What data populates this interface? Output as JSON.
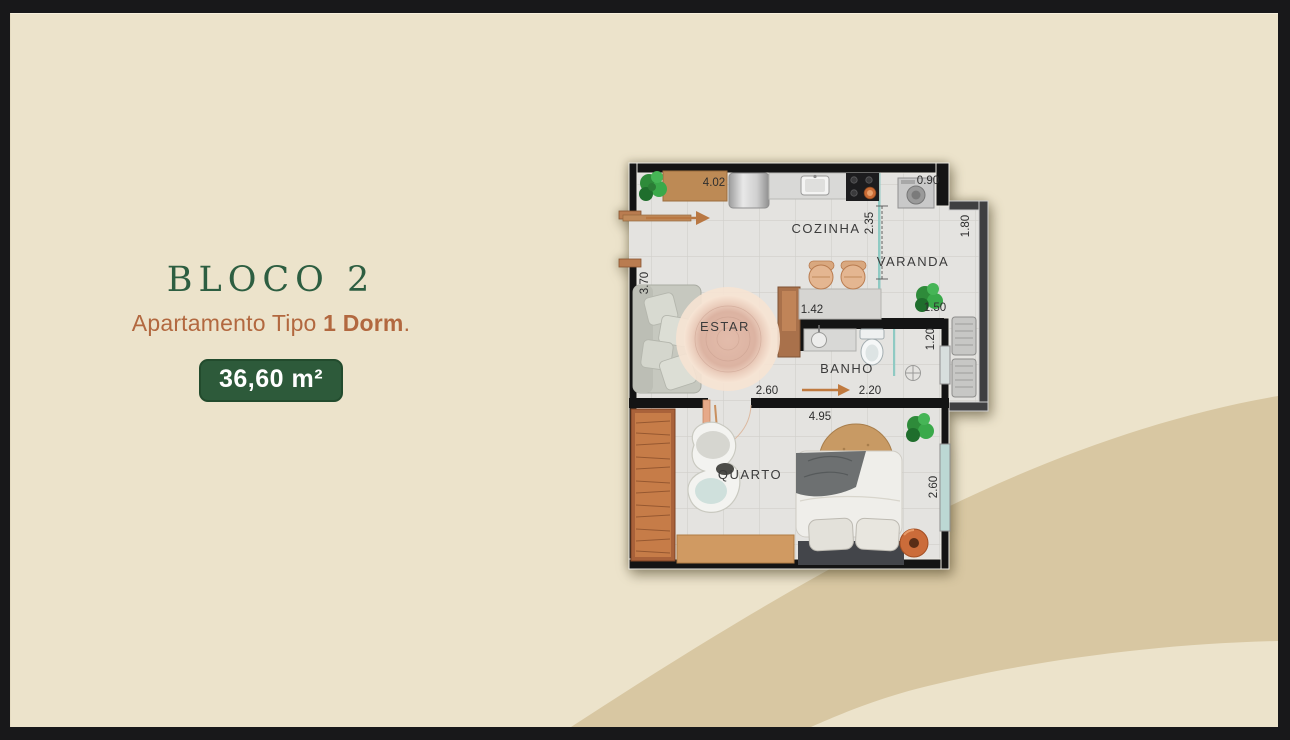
{
  "frame": {
    "color": "#18181a"
  },
  "canvas": {
    "background": "#ece3cb",
    "wave_color": "#d8c7a2"
  },
  "info_panel": {
    "block_title": "BLOCO 2",
    "type_prefix": "Apartamento Tipo ",
    "type_bold": "1 Dorm",
    "type_suffix": ".",
    "area_badge": "36,60 m²",
    "title_color": "#2d5e41",
    "subtitle_color": "#b2683f",
    "badge_background": "#2d5a3a",
    "badge_text_color": "#ffffff"
  },
  "floorplan": {
    "rooms": {
      "kitchen": "COZINHA",
      "balcony": "VARANDA",
      "living": "ESTAR",
      "bathroom": "BANHO",
      "bedroom": "QUARTO"
    },
    "dimensions": {
      "top_width": "4.02",
      "service_width": "0.90",
      "kitchen_depth": "2.35",
      "balcony_depth": "1.80",
      "living_depth": "3.70",
      "counter_width": "1.42",
      "balcony_width": "1.50",
      "tech_width": "1.20",
      "hall_width": "2.60",
      "bath_width": "2.20",
      "bedroom_width": "4.95",
      "bedroom_depth": "2.60"
    }
  }
}
